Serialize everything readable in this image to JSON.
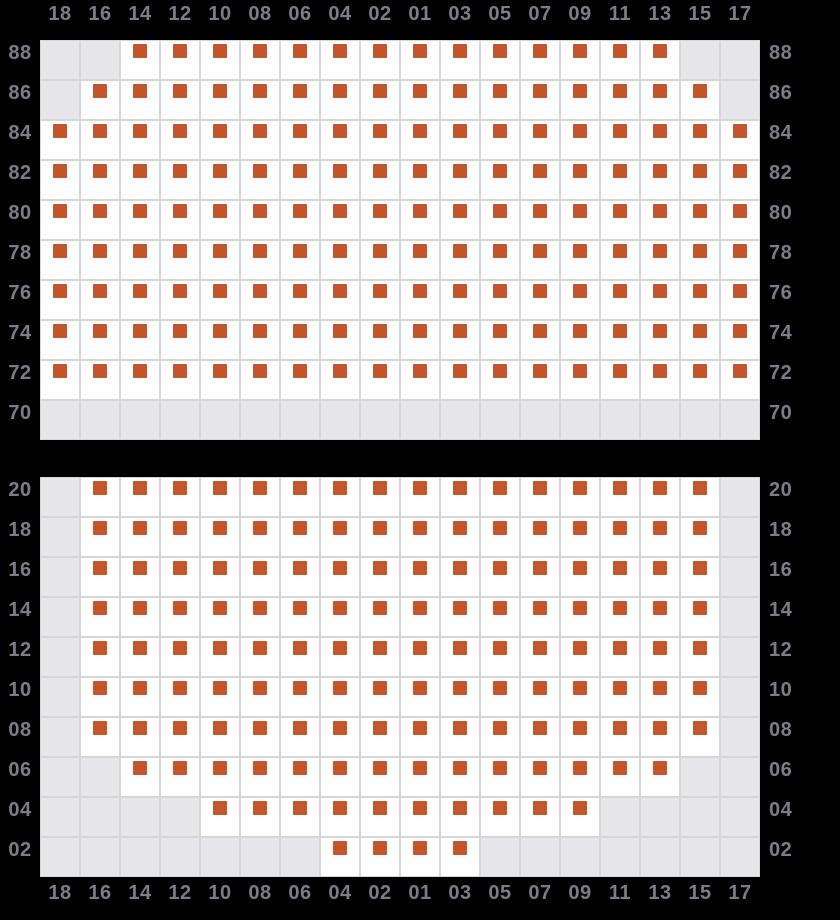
{
  "column_labels": [
    "18",
    "16",
    "14",
    "12",
    "10",
    "08",
    "06",
    "04",
    "02",
    "01",
    "03",
    "05",
    "07",
    "09",
    "11",
    "13",
    "15",
    "17"
  ],
  "sections": [
    {
      "name": "upper-seat-grid",
      "row_labels": [
        "88",
        "86",
        "84",
        "82",
        "80",
        "78",
        "76",
        "74",
        "72",
        "70"
      ],
      "rows": [
        "001111111111111100",
        "011111111111111110",
        "111111111111111111",
        "111111111111111111",
        "111111111111111111",
        "111111111111111111",
        "111111111111111111",
        "111111111111111111",
        "111111111111111111",
        "000000000000000000"
      ]
    },
    {
      "name": "lower-seat-grid",
      "row_labels": [
        "20",
        "18",
        "16",
        "14",
        "12",
        "10",
        "08",
        "06",
        "04",
        "02"
      ],
      "rows": [
        "011111111111111110",
        "011111111111111110",
        "011111111111111110",
        "011111111111111110",
        "011111111111111110",
        "011111111111111110",
        "011111111111111110",
        "001111111111111100",
        "000011111111110000",
        "000000011110000000"
      ]
    }
  ],
  "cell_states": {
    "1": "seat",
    "0": "blocked"
  },
  "icons": {
    "seat_marker": "filled-square"
  },
  "colors": {
    "background": "#000000",
    "seat_cell": "#ffffff",
    "blocked_cell": "#e7e7ea",
    "grid_border": "#d6d6da",
    "seat_marker": "#c5562b",
    "label_text": "#7d7d87"
  }
}
